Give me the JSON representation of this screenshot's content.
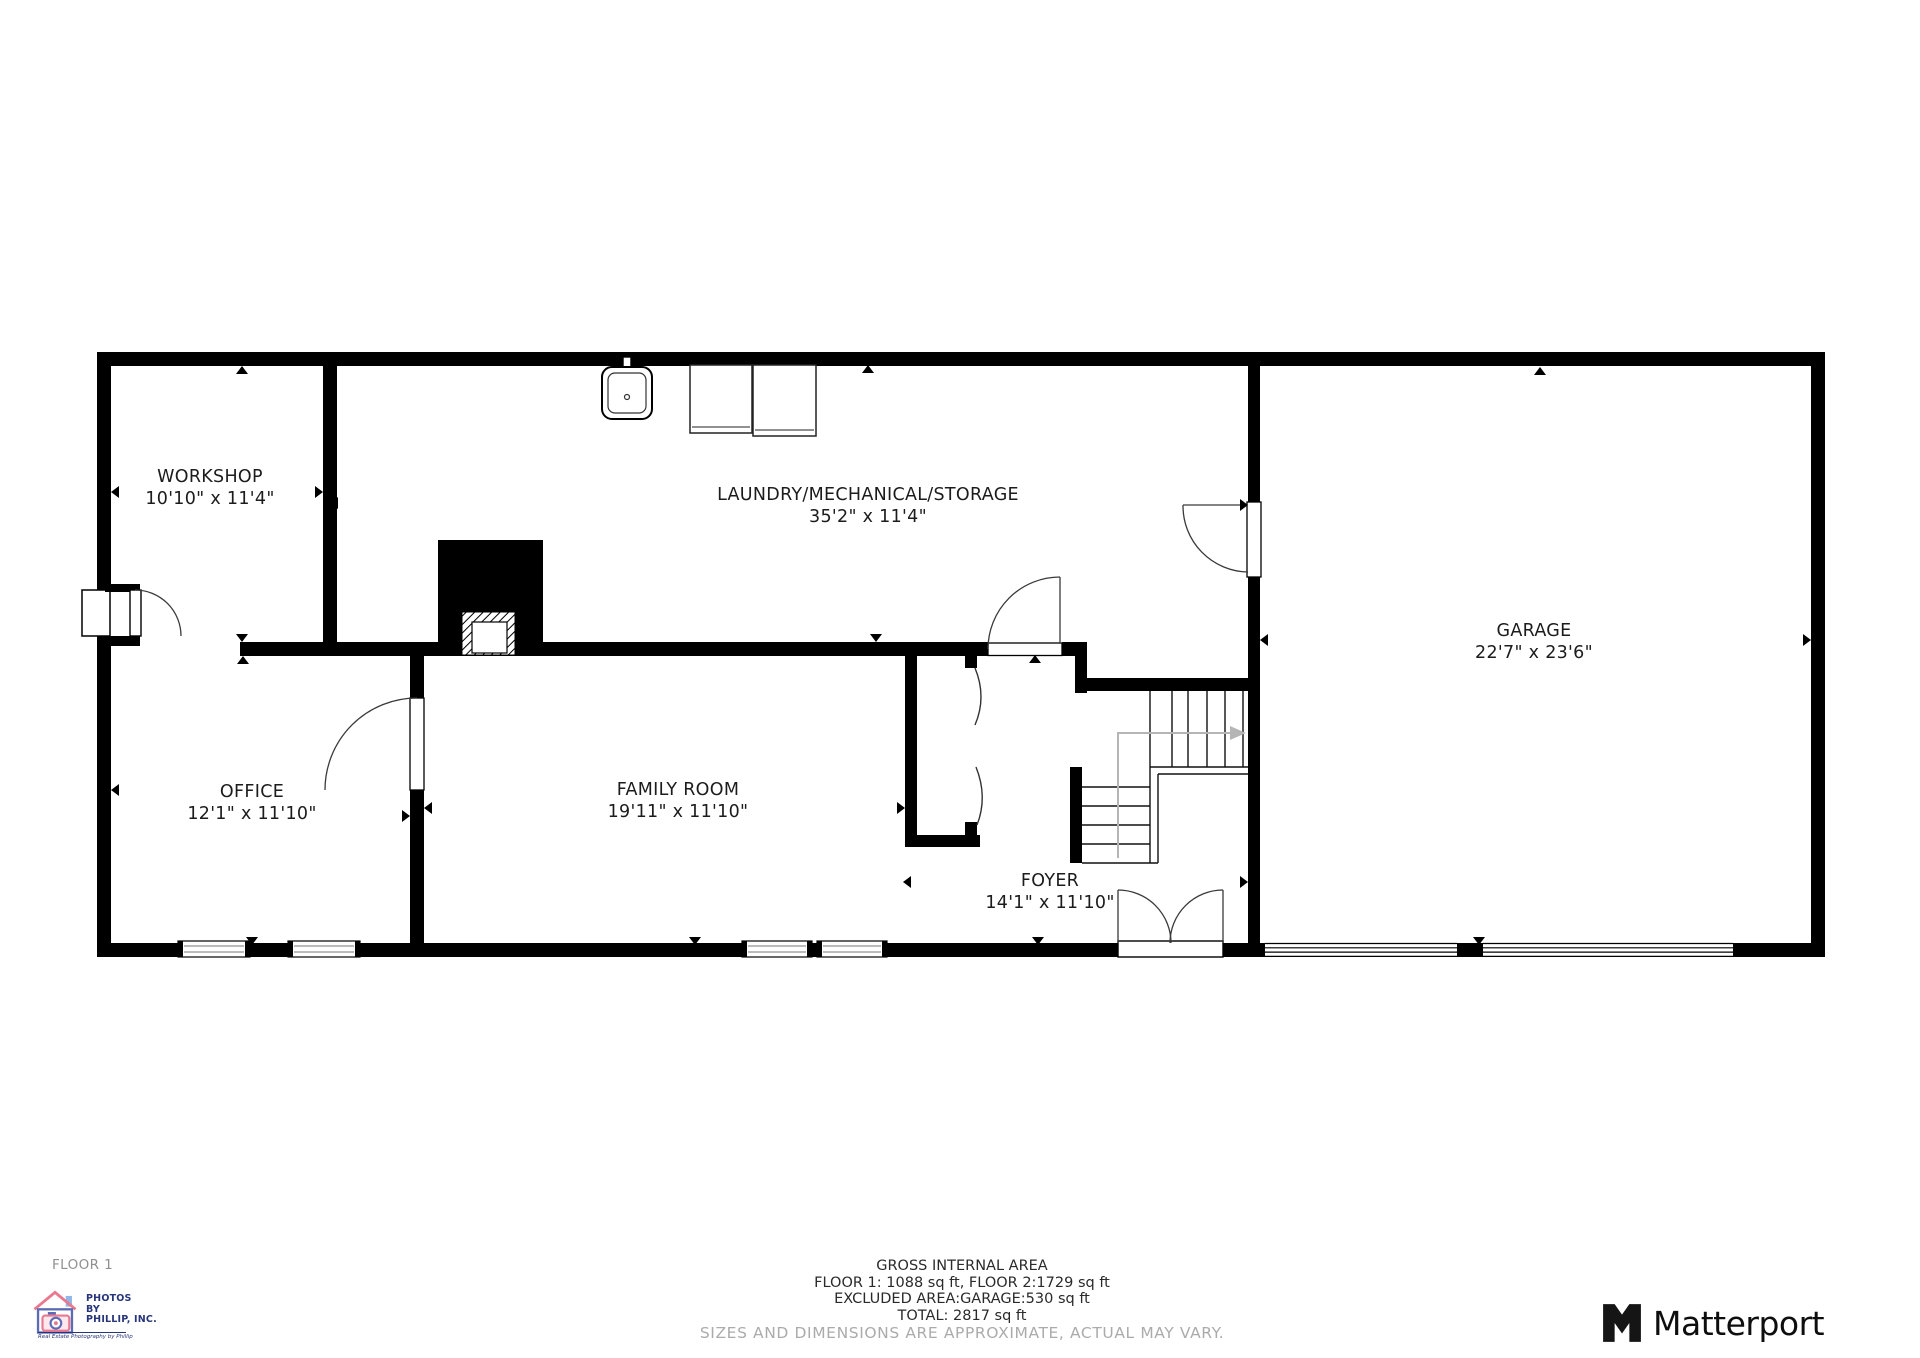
{
  "floor_label": "FLOOR 1",
  "rooms": {
    "workshop": {
      "name": "WORKSHOP",
      "dims": "10'10\" x 11'4\""
    },
    "laundry": {
      "name": "LAUNDRY/MECHANICAL/STORAGE",
      "dims": "35'2\" x 11'4\""
    },
    "garage": {
      "name": "GARAGE",
      "dims": "22'7\" x 23'6\""
    },
    "office": {
      "name": "OFFICE",
      "dims": "12'1\" x 11'10\""
    },
    "family_room": {
      "name": "FAMILY ROOM",
      "dims": "19'11\" x 11'10\""
    },
    "foyer": {
      "name": "FOYER",
      "dims": "14'1\" x 11'10\""
    }
  },
  "summary": {
    "title": "GROSS INTERNAL AREA",
    "line1": "FLOOR 1: 1088 sq ft, FLOOR 2:1729 sq ft",
    "line2": "EXCLUDED AREA:GARAGE:530 sq ft",
    "line3": "TOTAL: 2817 sq ft",
    "disclaimer": "SIZES AND DIMENSIONS ARE APPROXIMATE, ACTUAL MAY VARY."
  },
  "branding": {
    "matterport_wordmark": "Matterport",
    "photographer": {
      "line1": "PHOTOS",
      "line2": "BY",
      "line3": "PHILLIP, INC.",
      "tagline": "Real Estate Photography by Phillip"
    }
  },
  "colors": {
    "wall": "#000000",
    "label_text": "#1c1c1c",
    "muted_text": "#ababab",
    "stair_arrow": "#b5b5b5",
    "logo_navy": "#27357a",
    "logo_pink": "#e8798f",
    "logo_blue": "#5b6bb5"
  }
}
